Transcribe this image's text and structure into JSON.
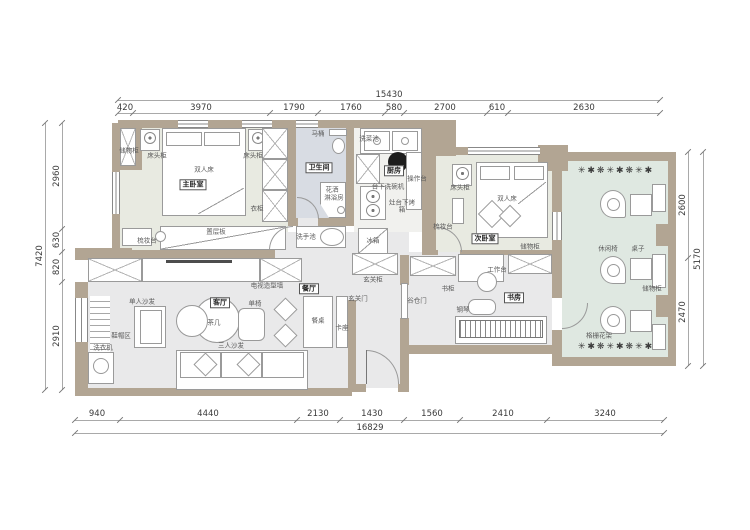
{
  "rooms": {
    "master_bedroom": "主卧室",
    "bathroom": "卫生间",
    "kitchen": "厨房",
    "second_bedroom": "次卧室",
    "study": "书房",
    "living_room": "客厅",
    "dining_room": "餐厅"
  },
  "labels": {
    "storage_cabinet": "储物柜",
    "nightstand": "床头柜",
    "double_bed": "双人床",
    "wardrobe": "衣柜",
    "shelf_board": "置层板",
    "dressing_table": "梳妆台",
    "toilet": "马桶",
    "shower_head": "花洒",
    "shower_room": "淋浴房",
    "veg_sink": "洗菜池",
    "counter_top": "操作台",
    "dishwasher": "台下洗碗机",
    "oven_under_counter": "灶台下烤箱",
    "hand_basin": "洗手池",
    "fridge": "冰箱",
    "work_top": "工作台",
    "bookcase": "书柜",
    "piano": "钢琴",
    "entry_cabinet": "玄关柜",
    "entry_door": "玄关门",
    "barn_door": "谷仓门",
    "tv_feature_wall": "电视造型墙",
    "single_sofa": "单人沙发",
    "tea_table": "茶几",
    "three_seat_sofa": "三人沙发",
    "single_chair": "单椅",
    "dining_table": "餐桌",
    "booth_seat": "卡座",
    "shoe_hat_area": "鞋帽区",
    "washing_machine": "洗衣机",
    "leisure_chair": "休闲椅",
    "small_table": "桌子",
    "flower_rack": "格栅花架"
  },
  "dimensions": {
    "top_total": "15430",
    "top": [
      "420",
      "3970",
      "1790",
      "1760",
      "580",
      "2700",
      "610",
      "2630"
    ],
    "bottom": [
      "940",
      "4440",
      "2130",
      "1430",
      "1560",
      "2410",
      "3240"
    ],
    "bottom_total": "16829",
    "left_total": "7420",
    "left": [
      "2960",
      "630",
      "820",
      "2910"
    ],
    "right_total": "5170",
    "right": [
      "2600",
      "2470"
    ]
  },
  "icons": {
    "plants_row": "✳✱❋✳✱❋✳✱",
    "flower": "❀"
  },
  "colors": {
    "wall": "#b2a593",
    "bedroom_fill": "#e8eae1",
    "bathroom_fill": "#d8dce3",
    "balcony_fill": "#dfe8e1",
    "floor_fill": "#e9e9ea",
    "kitchen_fill": "#f1f1ee"
  }
}
